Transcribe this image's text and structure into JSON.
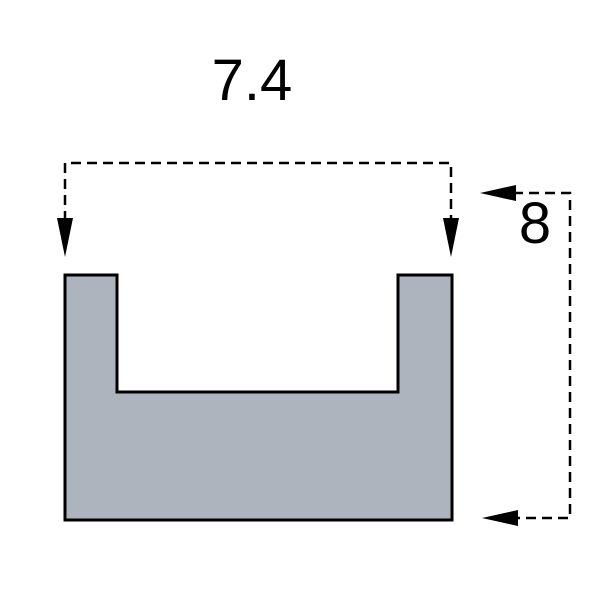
{
  "dimensions": {
    "width": {
      "label": "7.4"
    },
    "height": {
      "label": "8"
    }
  },
  "colors": {
    "shape_fill": "#aeb4bd",
    "shape_outline": "#000000",
    "dimension_line": "#000000",
    "text": "#000000",
    "background": "#ffffff"
  }
}
